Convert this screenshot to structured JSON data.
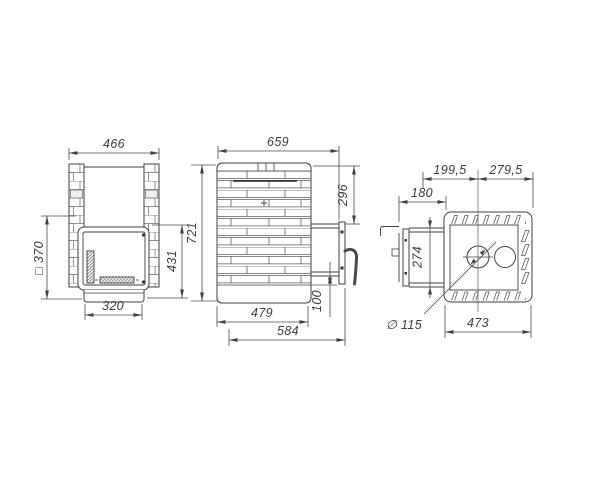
{
  "page": {
    "background": "#ffffff",
    "line_color": "#3f3f3f"
  },
  "front_view": {
    "overall_width": "466",
    "portal_square": "□ 370",
    "firebox_height": "431",
    "overall_height": "721",
    "base_width": "320"
  },
  "side_view": {
    "overall_depth": "659",
    "top_to_tunnel": "296",
    "tunnel_bottom_offset": "100",
    "base_depth": "479",
    "depth_with_door": "584"
  },
  "top_view": {
    "segment_left": "199,5",
    "segment_right": "279,5",
    "tunnel_length": "180",
    "tunnel_width": "274",
    "chimney_diameter": "∅ 115",
    "body_width": "473"
  }
}
